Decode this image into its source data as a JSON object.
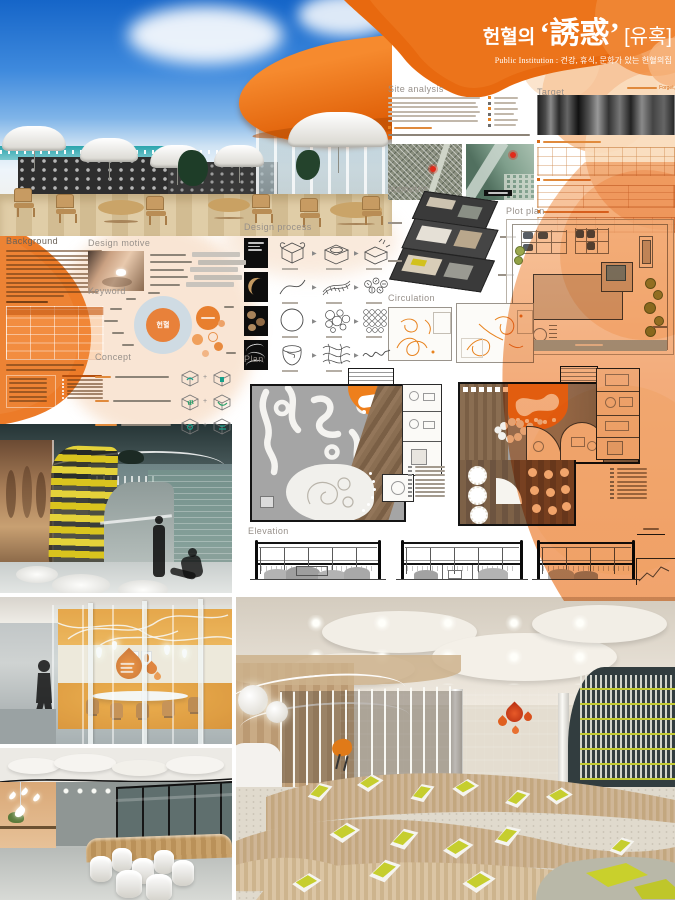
{
  "poster": {
    "title_prefix": "헌혈의",
    "title_hanja": "‘誘惑’",
    "title_bracket": "[유혹]",
    "subtitle": "Public Institution : 건강, 휴식, 문화가 있는  헌혈의집"
  },
  "sections": {
    "site_analysis": "Site analysis",
    "target": "Target",
    "isometric": "Isometric",
    "plot_plan": "Plot plan",
    "circulation": "Circulation",
    "design_process": "Design process",
    "plan": "Plan",
    "elevation": "Elevation",
    "background": "Background",
    "design_motive": "Design motive",
    "keyword": "Keyword",
    "concept": "Concept"
  },
  "keyword_diagram": {
    "center_label": "헌혈"
  },
  "target_section": {
    "caption": "Forget,"
  },
  "colors": {
    "primary_orange": "#e8690f",
    "light_orange": "#f5b27c",
    "pale_peach": "#fadcbd",
    "accent_yellow": "#c6ce2e"
  }
}
